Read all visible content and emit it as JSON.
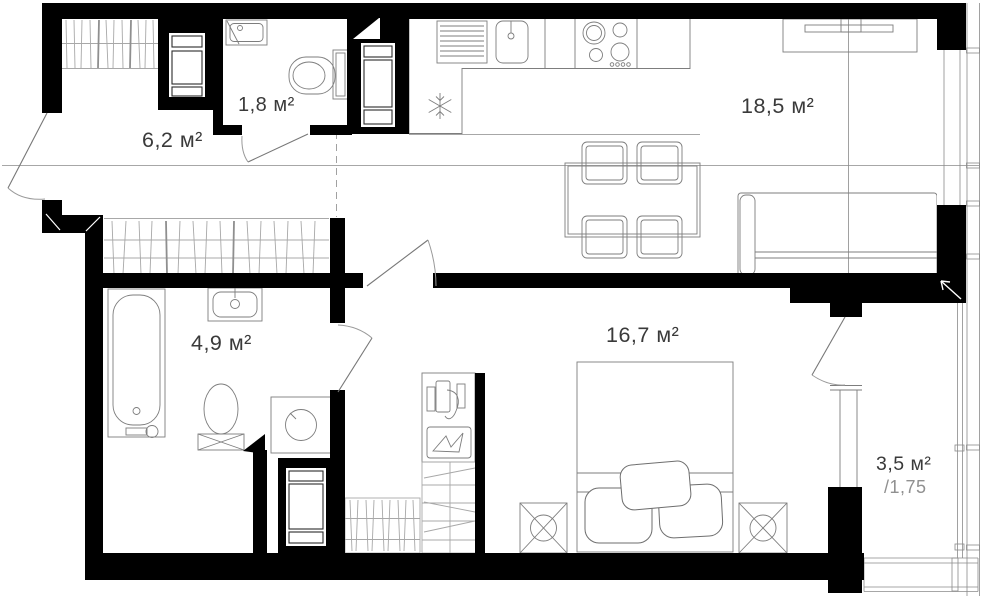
{
  "rooms": [
    {
      "id": "hallway",
      "label": "6,2 м²"
    },
    {
      "id": "wc",
      "label": "1,8 м²"
    },
    {
      "id": "kitchen_living",
      "label": "18,5 м²"
    },
    {
      "id": "bathroom",
      "label": "4,9 м²"
    },
    {
      "id": "bedroom",
      "label": "16,7 м²"
    },
    {
      "id": "balcony",
      "label": "3,5 м²",
      "coefficient": "/1,75"
    }
  ],
  "colors": {
    "wall": "#000000",
    "furniture_line": "#6e6e6e",
    "hatch_line": "#a8a8a8",
    "label": "#3a3a3a",
    "muted_label": "#909090",
    "background": "#ffffff"
  },
  "fixtures": [
    "entrance-door",
    "interior-door",
    "bathtub",
    "bathroom-sink",
    "toilet",
    "toilet-tank",
    "washing-machine",
    "kitchen-counter",
    "kitchen-sink",
    "drying-rack",
    "cooktop",
    "refrigerator-snowflake",
    "dining-table",
    "chair",
    "sofa",
    "tv-console",
    "double-bed",
    "pillow",
    "nightstand-lamp",
    "dresser",
    "wardrobe-hanging-rail",
    "wardrobe-shelves",
    "ventilation-shaft",
    "window",
    "balcony-glazing",
    "section-line",
    "zone-boundary"
  ]
}
